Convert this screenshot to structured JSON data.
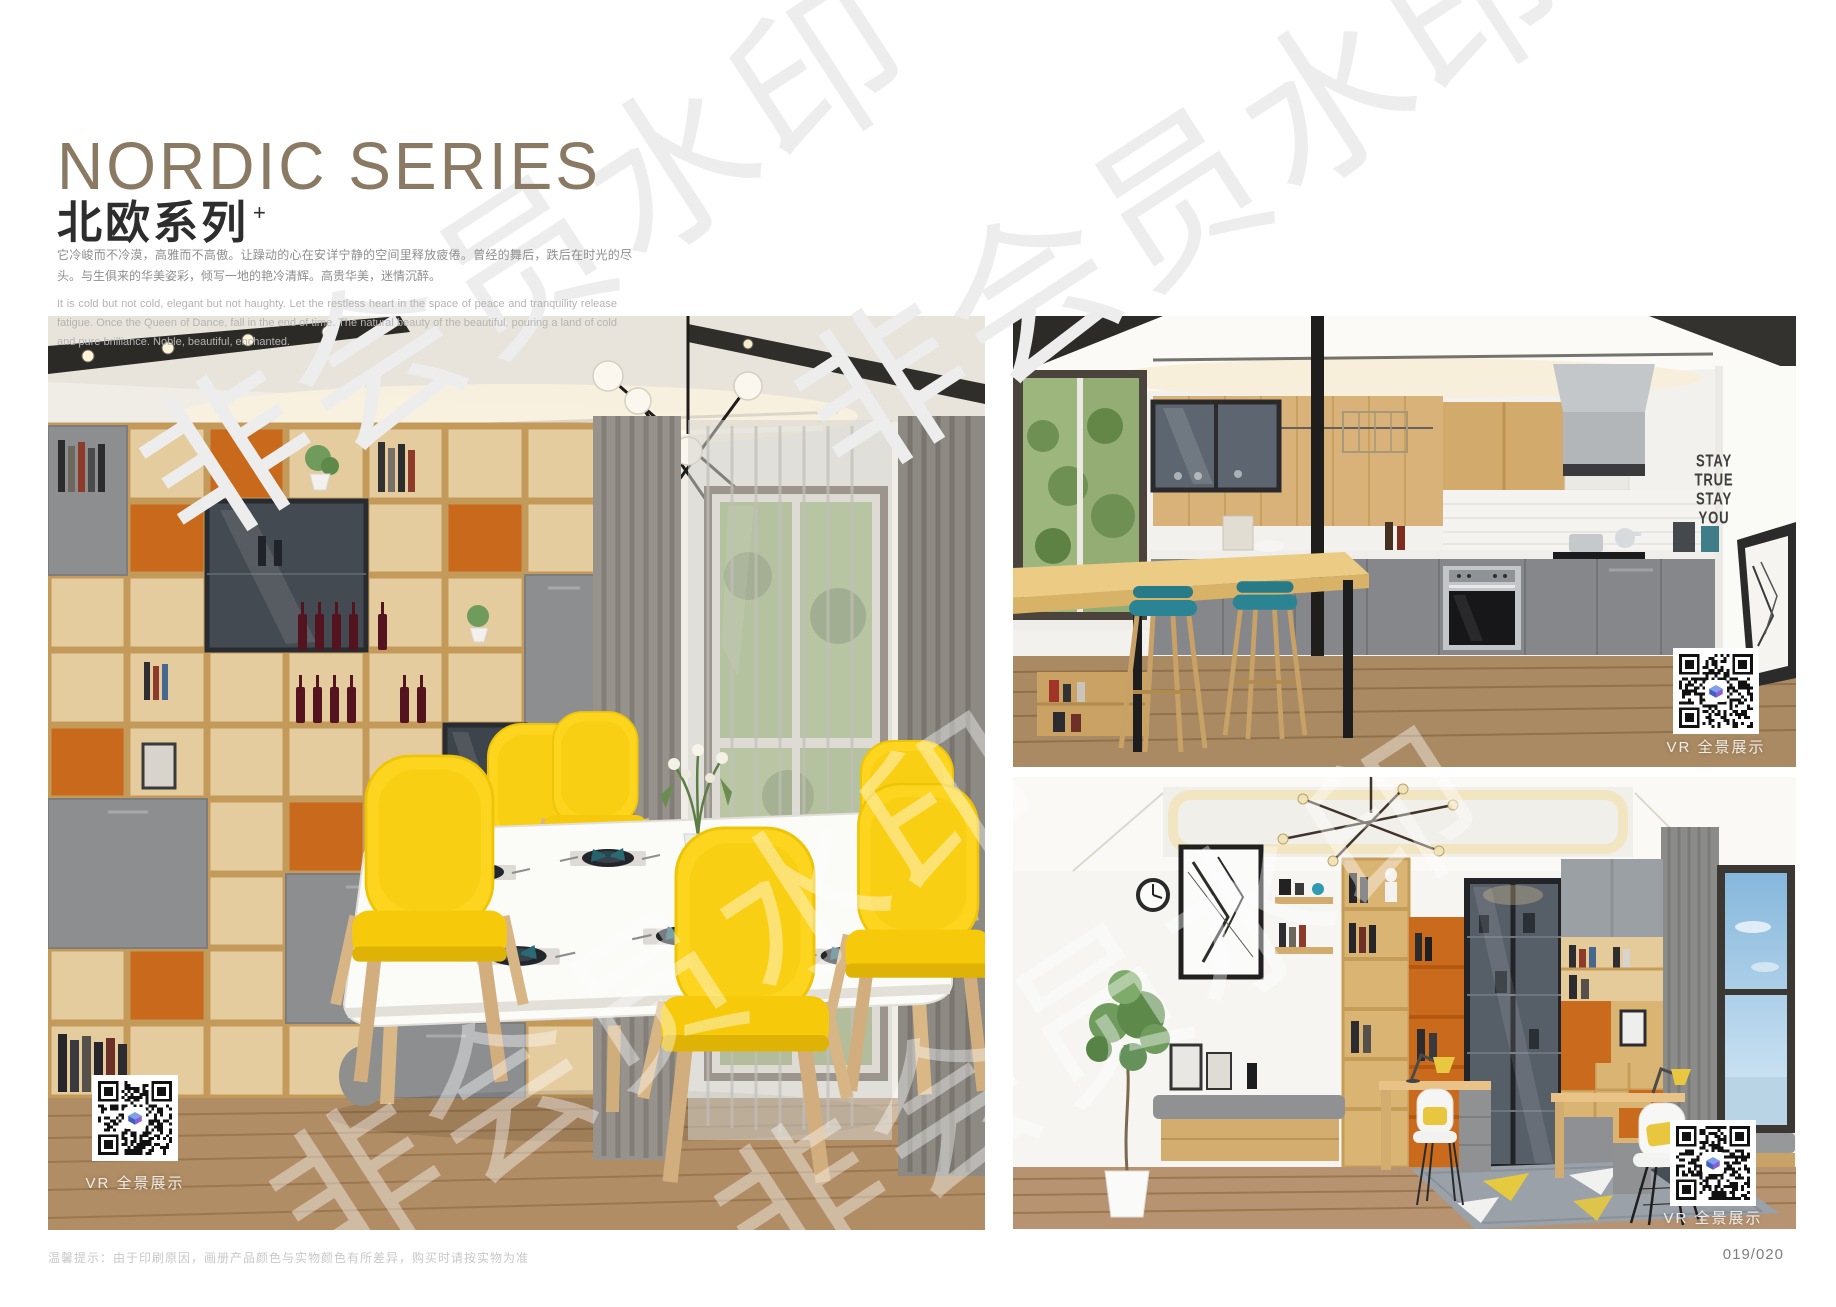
{
  "header": {
    "title_en": "NORDIC SERIES",
    "title_zh": "北欧系列",
    "title_sup": "+",
    "desc_zh": "它冷峻而不冷漠，高雅而不高傲。让躁动的心在安详宁静的空间里释放疲倦。曾经的舞后，跌后在时光的尽头。与生俱来的华美姿彩，倾写一地的艳冷清辉。高贵华美，迷情沉醉。",
    "desc_en": "It is cold but not cold, elegant but not haughty. Let the restless heart in the space of peace and tranquility release fatigue. Once the Queen of Dance, fall in the end of time. The natural beauty of the beautiful, pouring a land of cold and pure brilliance. Noble, beautiful, enchanted."
  },
  "photos": {
    "dining": {
      "alt": "Nordic dining room with wooden shelving wall, yellow chairs and white table",
      "vr_label": "VR 全景展示"
    },
    "kitchen": {
      "alt": "Open kitchen with wooden bar counter and teal stools",
      "vr_label": "VR 全景展示",
      "wall_text": [
        "STAY",
        "TRUE",
        "STAY",
        "YOU"
      ]
    },
    "study": {
      "alt": "Study room with bookcase, desks and window seat",
      "vr_label": "VR 全景展示"
    }
  },
  "watermark": {
    "text": "非会员水印"
  },
  "footer": {
    "disclaimer": "温馨提示：由于印刷原因，画册产品颜色与实物颜色有所差异，购买时请按实物为准",
    "page_number": "019/020"
  },
  "colors": {
    "title_taupe": "#8a7963",
    "accent_orange": "#c8691c",
    "chair_yellow": "#fdd41e",
    "stool_teal": "#2a7f8d",
    "cabinet_gray": "#8c8e90",
    "wood": "#d7b176"
  }
}
